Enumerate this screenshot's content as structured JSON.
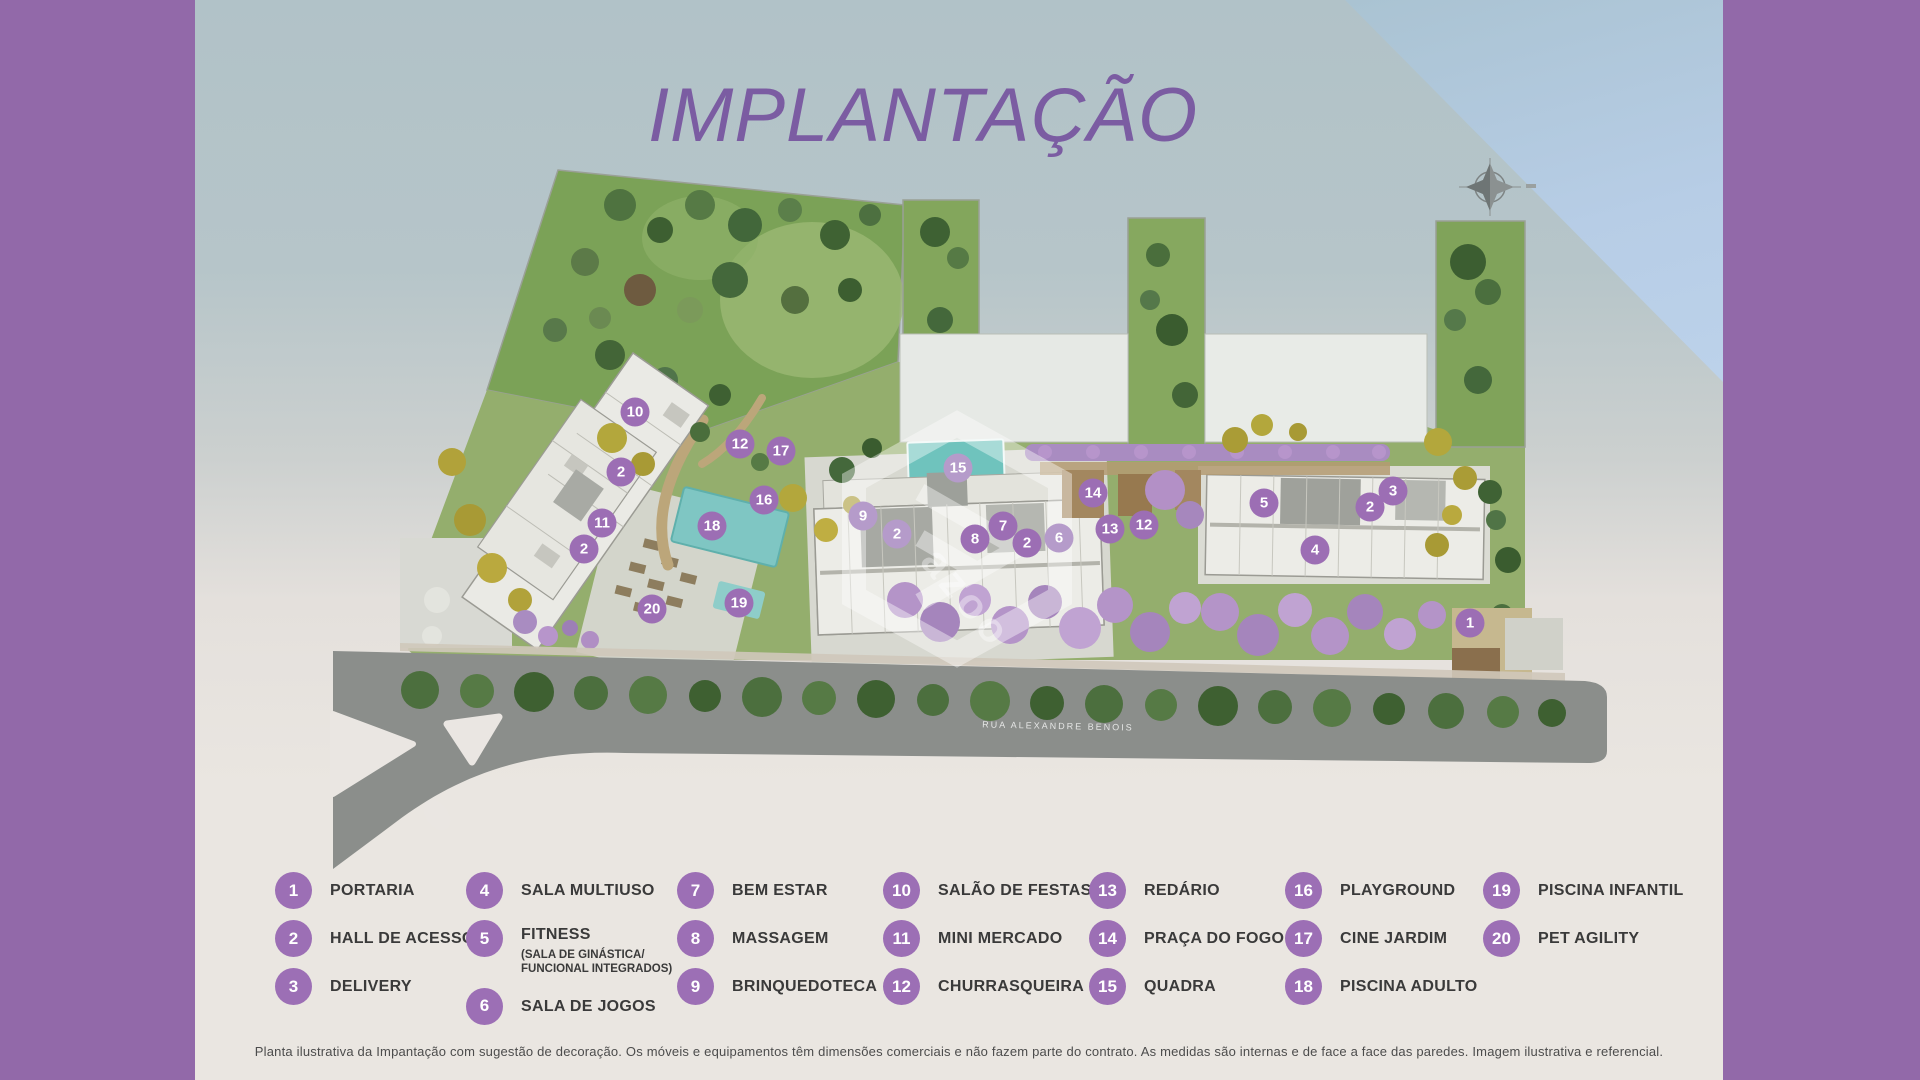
{
  "theme": {
    "band_purple": "#9269a9",
    "title_purple": "#7b5ca2",
    "marker_purple": "#9c6eb4",
    "marker_light": "#b59bca",
    "legend_purple": "#9c6fb5",
    "sky_triangle": "#b7cde6",
    "cream": "#eae6e1",
    "text_dark": "#3a3a3a"
  },
  "header": {
    "title": "IMPLANTAÇÃO"
  },
  "plan": {
    "road_label": "RUA ALEXANDRE BENOIS",
    "watermark_text": "azoo",
    "compass_icon": "compass-rose",
    "markers": [
      {
        "num": "10",
        "x": 635,
        "y": 412,
        "light": false
      },
      {
        "num": "12",
        "x": 740,
        "y": 444,
        "light": false
      },
      {
        "num": "17",
        "x": 781,
        "y": 451,
        "light": false
      },
      {
        "num": "2",
        "x": 621,
        "y": 472,
        "light": false
      },
      {
        "num": "16",
        "x": 764,
        "y": 500,
        "light": false
      },
      {
        "num": "11",
        "x": 602,
        "y": 523,
        "light": false
      },
      {
        "num": "2",
        "x": 584,
        "y": 549,
        "light": false
      },
      {
        "num": "18",
        "x": 712,
        "y": 526,
        "light": false
      },
      {
        "num": "20",
        "x": 652,
        "y": 609,
        "light": false
      },
      {
        "num": "19",
        "x": 739,
        "y": 603,
        "light": false
      },
      {
        "num": "15",
        "x": 958,
        "y": 468,
        "light": true
      },
      {
        "num": "9",
        "x": 863,
        "y": 516,
        "light": true
      },
      {
        "num": "2",
        "x": 897,
        "y": 534,
        "light": true
      },
      {
        "num": "8",
        "x": 975,
        "y": 539,
        "light": false
      },
      {
        "num": "7",
        "x": 1003,
        "y": 526,
        "light": false
      },
      {
        "num": "2",
        "x": 1027,
        "y": 543,
        "light": false
      },
      {
        "num": "6",
        "x": 1059,
        "y": 538,
        "light": true
      },
      {
        "num": "14",
        "x": 1093,
        "y": 493,
        "light": false
      },
      {
        "num": "13",
        "x": 1110,
        "y": 529,
        "light": false
      },
      {
        "num": "12",
        "x": 1144,
        "y": 525,
        "light": false
      },
      {
        "num": "5",
        "x": 1264,
        "y": 503,
        "light": false
      },
      {
        "num": "2",
        "x": 1370,
        "y": 507,
        "light": false
      },
      {
        "num": "3",
        "x": 1393,
        "y": 491,
        "light": false
      },
      {
        "num": "4",
        "x": 1315,
        "y": 550,
        "light": false
      },
      {
        "num": "1",
        "x": 1470,
        "y": 623,
        "light": false
      }
    ]
  },
  "legend": {
    "columns": [
      {
        "items": [
          {
            "num": "1",
            "label": "PORTARIA"
          },
          {
            "num": "2",
            "label": "HALL DE ACESSO"
          },
          {
            "num": "3",
            "label": "DELIVERY"
          }
        ]
      },
      {
        "items": [
          {
            "num": "4",
            "label": "SALA MULTIUSO"
          },
          {
            "num": "5",
            "label": "FITNESS",
            "sublabel": "(SALA DE GINÁSTICA/ FUNCIONAL INTEGRADOS)"
          },
          {
            "num": "6",
            "label": "SALA DE JOGOS"
          }
        ]
      },
      {
        "items": [
          {
            "num": "7",
            "label": "BEM ESTAR"
          },
          {
            "num": "8",
            "label": "MASSAGEM"
          },
          {
            "num": "9",
            "label": "BRINQUEDOTECA"
          }
        ]
      },
      {
        "items": [
          {
            "num": "10",
            "label": "SALÃO DE FESTAS"
          },
          {
            "num": "11",
            "label": "MINI MERCADO"
          },
          {
            "num": "12",
            "label": "CHURRASQUEIRA"
          }
        ]
      },
      {
        "items": [
          {
            "num": "13",
            "label": "REDÁRIO"
          },
          {
            "num": "14",
            "label": "PRAÇA DO FOGO"
          },
          {
            "num": "15",
            "label": "QUADRA"
          }
        ]
      },
      {
        "items": [
          {
            "num": "16",
            "label": "PLAYGROUND"
          },
          {
            "num": "17",
            "label": "CINE JARDIM"
          },
          {
            "num": "18",
            "label": "PISCINA ADULTO"
          }
        ]
      },
      {
        "items": [
          {
            "num": "19",
            "label": "PISCINA INFANTIL"
          },
          {
            "num": "20",
            "label": "PET AGILITY"
          }
        ]
      }
    ]
  },
  "footer": {
    "disclaimer": "Planta ilustrativa da Impantação com sugestão de decoração. Os móveis e equipamentos têm dimensões comerciais e não fazem parte do contrato. As medidas são internas e de face a face das paredes. Imagem ilustrativa e referencial."
  }
}
